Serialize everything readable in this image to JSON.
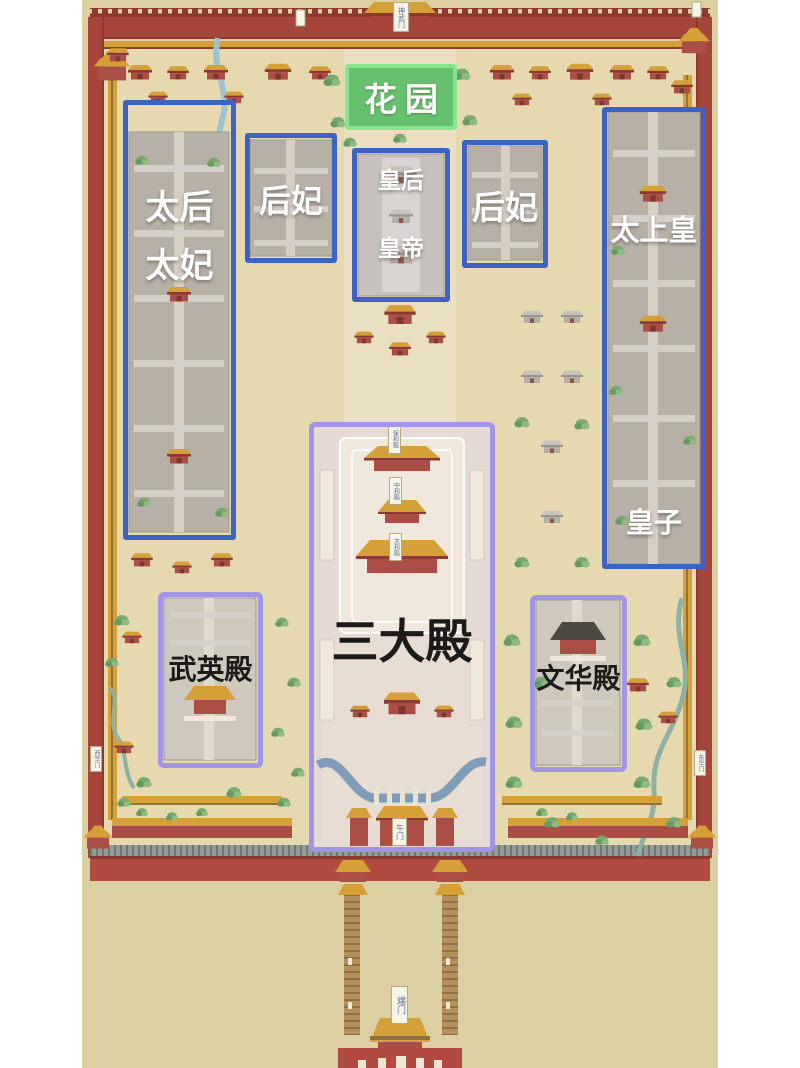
{
  "labels": {
    "garden": "花园",
    "empress_dowager_line1": "太后",
    "empress_dowager_line2": "太妃",
    "consorts_west": "后妃",
    "empress": "皇后",
    "emperor": "皇帝",
    "consorts_east": "后妃",
    "retired_emperor": "太上皇",
    "princes": "皇子",
    "three_great_halls": "三大殿",
    "wuying_hall": "武英殿",
    "wenhua_hall": "文华殿"
  },
  "plaques": {
    "shenwu_gate": "神武门",
    "baohe_hall": "保和殿",
    "zhonghe_hall": "中和殿",
    "taihe_hall": "太和殿",
    "wu_gate": "午门",
    "duan_gate": "端门",
    "xihua_gate": "西华门",
    "donghua_gate": "东华门"
  },
  "colors": {
    "page_bg": "#ffffff",
    "map_bg": "#dccfa2",
    "ground": "#e6d9b0",
    "axis": "#eadfc2",
    "wall_red": "#a6453c",
    "wall_dark": "#8c3a31",
    "bottom_wall": "#b14a41",
    "walkway": "#919d96",
    "roof_gold": "#d4a037",
    "body_red": "#ab4f46",
    "box_blue": "#3c63c4",
    "box_purple": "#a395e5",
    "garden_border": "#86e68e",
    "garden_fill": "rgba(74,186,90,0.82)",
    "pink_court": "#e7dad4",
    "terrace": "#f0e8dd",
    "gray_court": "#b7b0a6",
    "gray_roof": "#d4cfc7",
    "river": "#7f9cb8",
    "stream": "#8fb0a6",
    "label_white": "#ffffff",
    "label_black": "#1d1b1a",
    "plaque_bg": "#f6f3e9",
    "plaque_border": "#b9a97e",
    "plaque_text": "#5d6f95"
  }
}
